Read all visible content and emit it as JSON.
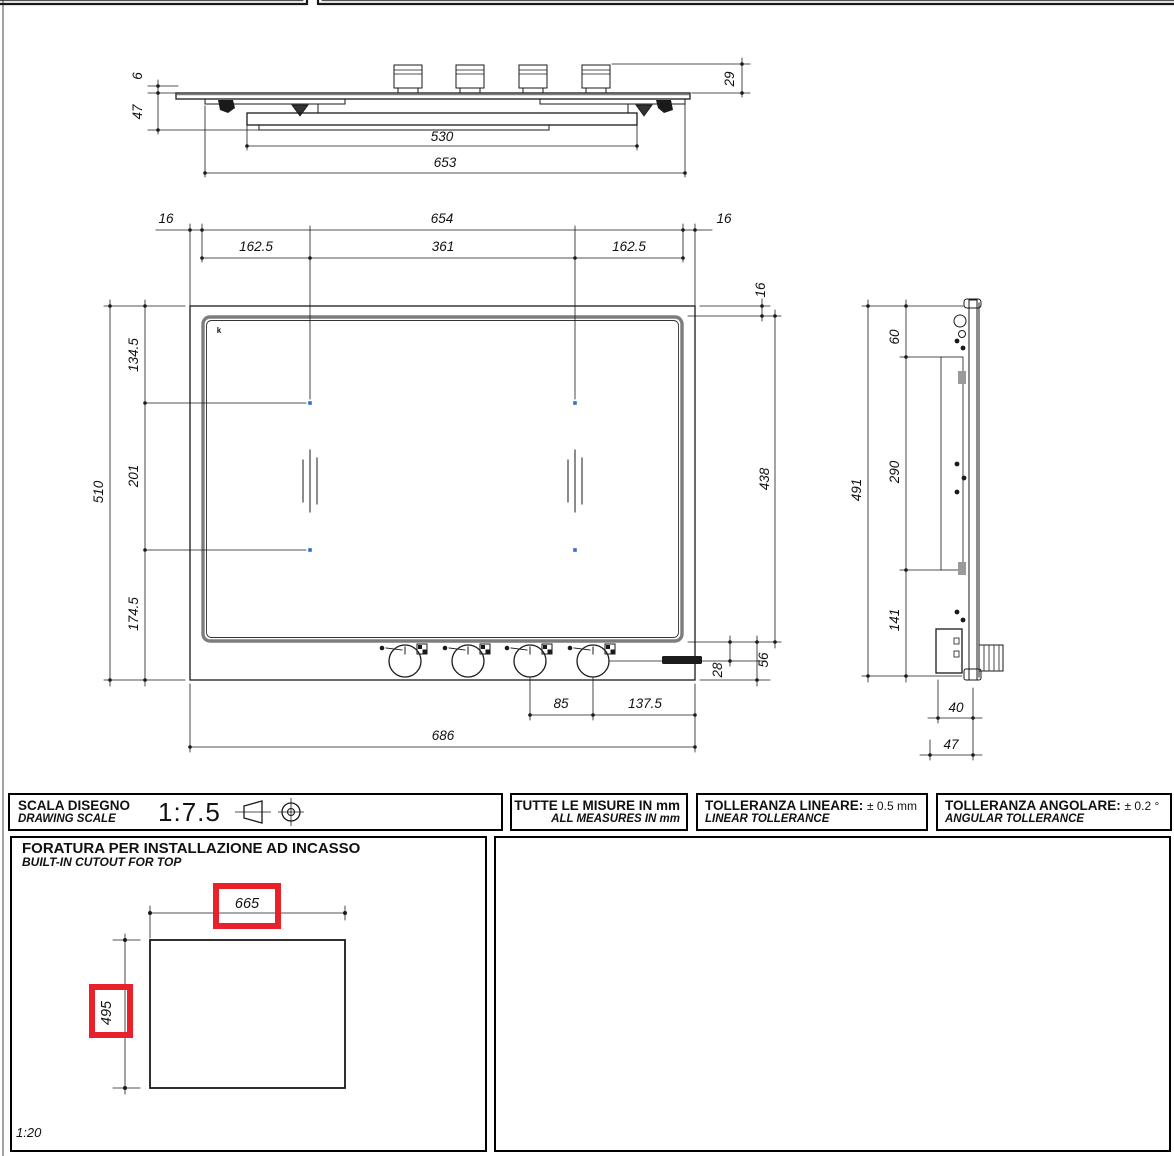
{
  "colors": {
    "line": "#1a1a1a",
    "glass_gray": "#7d7d7d",
    "burner_blue": "#2e6fce",
    "highlight_red": "#e8222a"
  },
  "front_view": {
    "glass_thickness": "6",
    "under_depth": "47",
    "knob_height": "29",
    "body_width": "530",
    "overall_width": "653"
  },
  "plan_view": {
    "trim_left": "16",
    "glass_width": "654",
    "trim_right": "16",
    "burner_offset_left": "162.5",
    "burner_spacing": "361",
    "burner_offset_right": "162.5",
    "trim_top": "16",
    "glass_depth": "438",
    "overall_depth": "510",
    "row_top_offset": "134.5",
    "row_spacing": "201",
    "row_bottom_offset": "174.5",
    "knob_center_offset": "28",
    "front_strip_depth": "56",
    "knob_spacing": "85",
    "knob_edge_offset": "137.5",
    "overall_width": "686",
    "corner_mark": "k"
  },
  "side_view": {
    "overall_height": "491",
    "top_offset": "60",
    "bracket_span": "290",
    "bottom_offset": "141",
    "box_width": "40",
    "overall_depth": "47"
  },
  "footer": {
    "scale_label_it": "SCALA DISEGNO",
    "scale_label_en": "DRAWING SCALE",
    "scale_value": "1:7.5",
    "measures_it": "TUTTE LE MISURE IN mm",
    "measures_en": "ALL MEASURES IN mm",
    "linear_tol_it": "TOLLERANZA LINEARE:",
    "linear_tol_value": "± 0.5 mm",
    "linear_tol_en": "LINEAR TOLLERANCE",
    "angular_tol_it": "TOLLERANZA ANGOLARE:",
    "angular_tol_value": "± 0.2 °",
    "angular_tol_en": "ANGULAR TOLLERANCE"
  },
  "cutout": {
    "title_it": "FORATURA PER INSTALLAZIONE AD INCASSO",
    "title_en": "BUILT-IN CUTOUT FOR TOP",
    "width": "665",
    "height": "495",
    "scale": "1:20"
  }
}
